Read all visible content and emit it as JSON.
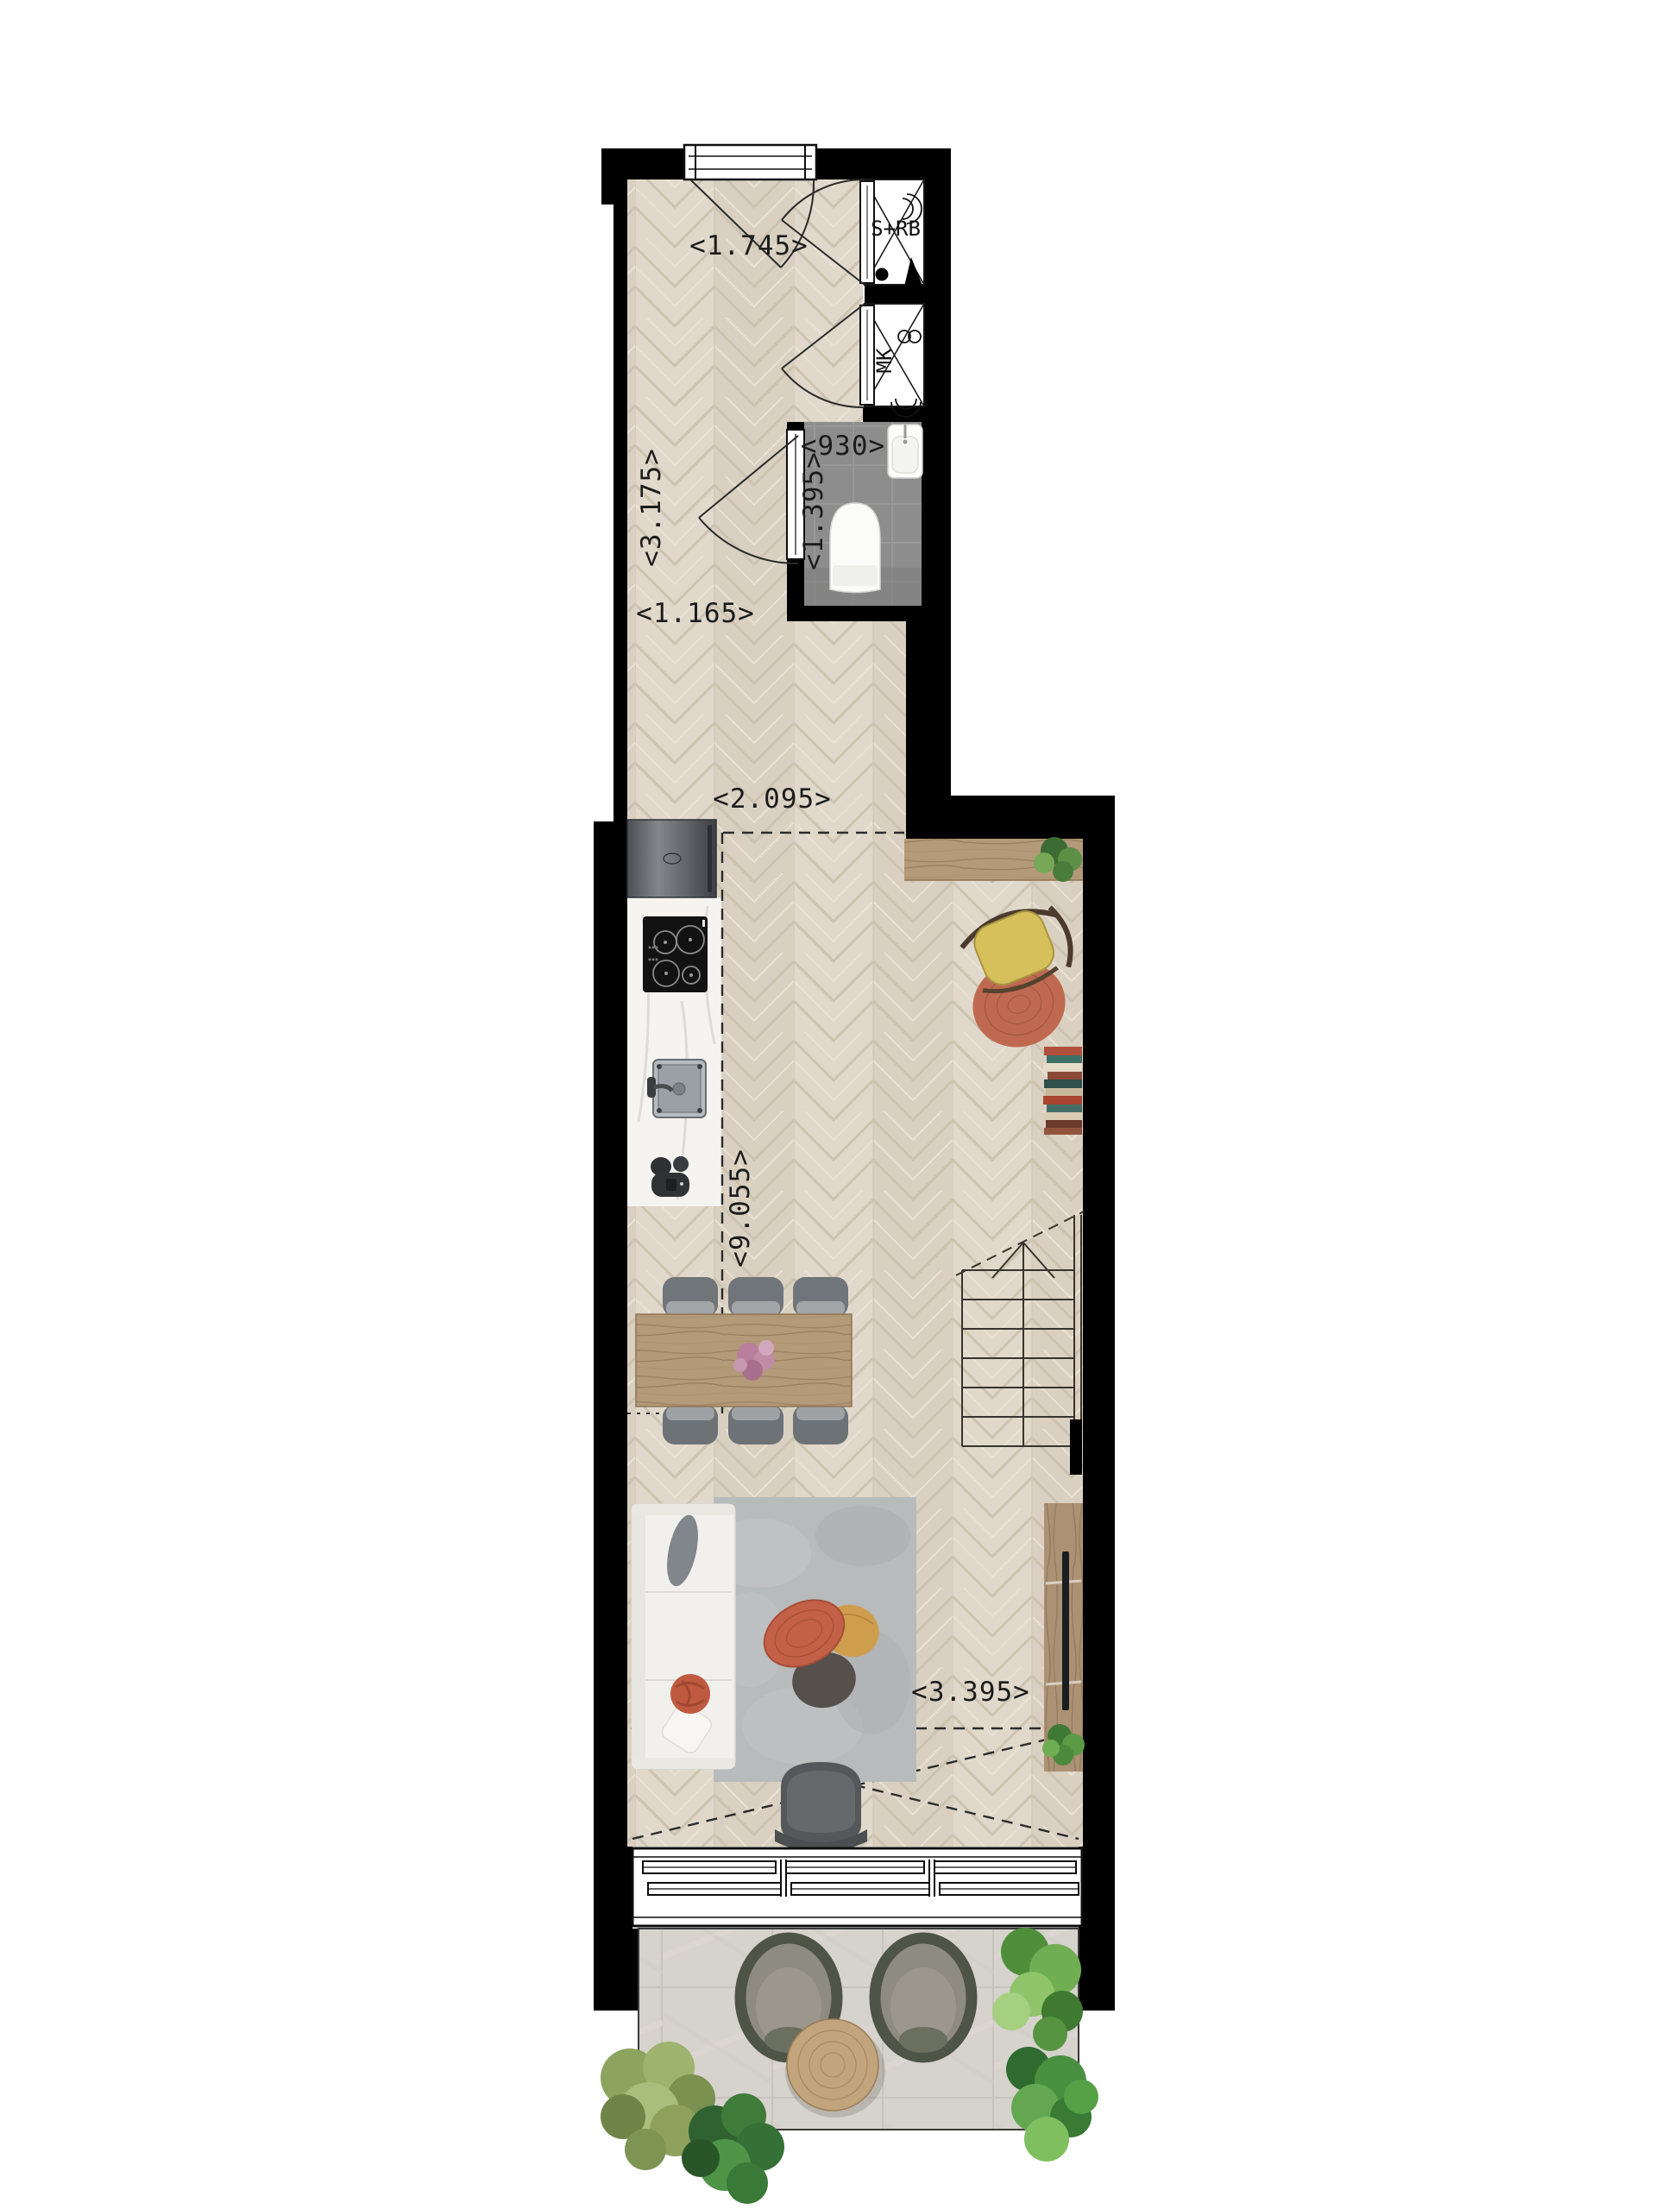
{
  "plan": {
    "dims": [
      {
        "id": "entry-width",
        "label": "<1.745>"
      },
      {
        "id": "hall-length-upper",
        "label": "<3.175>"
      },
      {
        "id": "wc-width",
        "label": "<930>"
      },
      {
        "id": "wc-length",
        "label": "<1.395>"
      },
      {
        "id": "hall-width-lower",
        "label": "<1.165>"
      },
      {
        "id": "kitchen-zone-width",
        "label": "<2.095>"
      },
      {
        "id": "living-length",
        "label": "<9.055>"
      },
      {
        "id": "living-width",
        "label": "<3.395>"
      }
    ],
    "closets": {
      "utility": "S+RB",
      "meter": "MK"
    },
    "colors": {
      "wall": "#000000",
      "floor_wood": "#ded5c7",
      "wc_tile": "#8d8d8d",
      "terrace_tile": "#d6d2cc",
      "furniture_wood": "#b39a79",
      "sofa_white": "#f1f0ec",
      "rug_gray": "#b8bbbc",
      "accent_red": "#c26048",
      "accent_mustard": "#cf9e4d",
      "accent_yellow": "#d5c05c",
      "plant_green": "#4f9440"
    }
  }
}
